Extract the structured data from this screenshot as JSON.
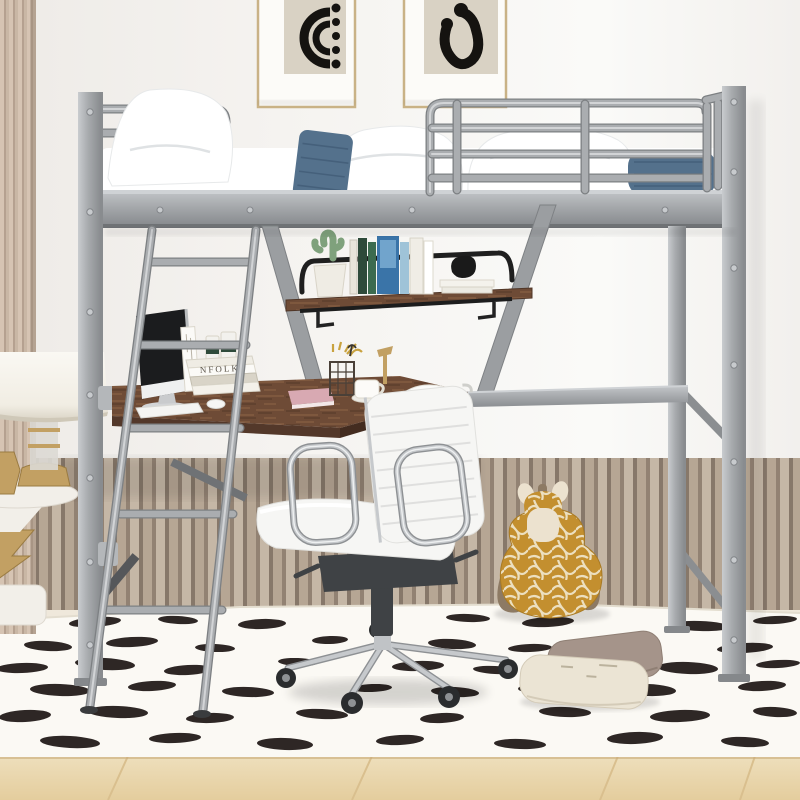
{
  "meta": {
    "type": "product-photo",
    "subject": "Silver metal twin loft bed with built-in L-shaped desk and shelf in a kids room with white office chair, giraffe plush, spotted rug and slat-panel wainscoting"
  },
  "palette": {
    "wall": "#f4f2ef",
    "wall_bright": "#fbfaf8",
    "wainscot_light": "#d0c1af",
    "wainscot_mid": "#c0af9c",
    "wainscot_dark": "#8f7f70",
    "wainscot_dark2": "#9a897a",
    "baseboard": "#efe8db",
    "floor_cream": "#f0ead9",
    "floor_wood": "#e9d5ab",
    "floor_wood_dark": "#d9bf8e",
    "rug": "#fbf9f4",
    "rug_spot": "#1c1512",
    "metal": "#a8abae",
    "metal_light": "#cdd0d3",
    "metal_dark": "#85888b",
    "wood_desk": "#6e4b36",
    "wood_desk_edge": "#53382a",
    "wood_streak": "#8a5f43",
    "shelf_rail": "#222222",
    "mattress": "#ffffff",
    "cushion_blue": "#54718c",
    "cushion_blue_dark": "#3f5a74",
    "chair_white": "#f6f6f4",
    "chrome": "#c6c9cc",
    "mech_dark": "#3f4245",
    "caster": "#2a2c2e",
    "giraffe": "#c38f2f",
    "giraffe_cream": "#ece2cf",
    "giraffe_brown": "#8d7a64",
    "pillow_taupe": "#a5948a",
    "pillow_cream": "#ebe4d4",
    "lamp_shade": "#f6f3ec",
    "gold": "#c2a063",
    "gold_dark": "#9a7b42",
    "marble": "#f2efe9",
    "curtain_light": "#d6c4b3",
    "curtain_mid": "#c9b7a5",
    "curtain_dark": "#b5a190",
    "art_bg": "#d9d2c4",
    "art_ink": "#151310",
    "frame_gold": "#c9b286",
    "mat_white": "#fcfbf8"
  },
  "text": {
    "desk_book_spine": "NFOLK"
  },
  "objects": [
    "framed abstract art print with concentric arcs",
    "framed abstract art print with ear-shaped hook",
    "beige striped curtain edge",
    "silver metal loft bed frame with guardrails",
    "white mattress with white pillows and two denim blue cushions",
    "slanted silver metal ladder",
    "hanging shelf with cactus, books and knot sculpture",
    "L-shaped walnut desk with monitor, book stack, candles, pink book, wire pencil cup, mug and gold lamp",
    "white ribbed office chair with chrome base and casters",
    "white drum-shade table lamp on marble and gold side table",
    "plush giraffe toy",
    "two floor pillows (taupe and cream)",
    "white rug with black brush-dash spots",
    "slat panel wainscoting",
    "light oak wood floor"
  ],
  "rug": {
    "spot_color": "#1c1512",
    "spots": [
      [
        95,
        622,
        26,
        5,
        -4
      ],
      [
        178,
        620,
        20,
        4,
        3
      ],
      [
        262,
        624,
        24,
        5,
        -2
      ],
      [
        468,
        618,
        22,
        4,
        2
      ],
      [
        548,
        622,
        26,
        5,
        -3
      ],
      [
        700,
        626,
        30,
        5,
        2
      ],
      [
        775,
        620,
        22,
        4,
        -3
      ],
      [
        48,
        646,
        24,
        5,
        3
      ],
      [
        132,
        642,
        26,
        5,
        -3
      ],
      [
        215,
        648,
        20,
        4,
        2
      ],
      [
        330,
        640,
        18,
        4,
        -2
      ],
      [
        452,
        644,
        24,
        5,
        3
      ],
      [
        530,
        648,
        22,
        4,
        -2
      ],
      [
        615,
        642,
        26,
        5,
        2
      ],
      [
        745,
        648,
        28,
        5,
        -3
      ],
      [
        22,
        668,
        26,
        5,
        -2
      ],
      [
        105,
        664,
        30,
        6,
        3
      ],
      [
        188,
        670,
        24,
        5,
        -3
      ],
      [
        298,
        662,
        20,
        4,
        2
      ],
      [
        418,
        666,
        26,
        5,
        -2
      ],
      [
        495,
        670,
        22,
        4,
        3
      ],
      [
        582,
        664,
        24,
        5,
        -2
      ],
      [
        688,
        668,
        30,
        6,
        2
      ],
      [
        778,
        664,
        22,
        4,
        -3
      ],
      [
        60,
        690,
        30,
        6,
        2
      ],
      [
        152,
        686,
        24,
        5,
        -3
      ],
      [
        248,
        692,
        26,
        5,
        2
      ],
      [
        372,
        688,
        20,
        4,
        -2
      ],
      [
        455,
        692,
        24,
        5,
        3
      ],
      [
        540,
        688,
        22,
        5,
        -2
      ],
      [
        648,
        690,
        28,
        6,
        2
      ],
      [
        762,
        686,
        24,
        5,
        -3
      ],
      [
        25,
        716,
        26,
        6,
        -3
      ],
      [
        118,
        712,
        30,
        6,
        2
      ],
      [
        210,
        718,
        24,
        5,
        -2
      ],
      [
        322,
        714,
        26,
        5,
        3
      ],
      [
        442,
        718,
        22,
        5,
        -3
      ],
      [
        565,
        712,
        26,
        5,
        2
      ],
      [
        680,
        716,
        30,
        6,
        -2
      ],
      [
        775,
        712,
        22,
        5,
        3
      ],
      [
        70,
        742,
        30,
        6,
        3
      ],
      [
        175,
        738,
        26,
        5,
        -2
      ],
      [
        285,
        744,
        28,
        6,
        2
      ],
      [
        400,
        740,
        24,
        5,
        -3
      ],
      [
        520,
        744,
        26,
        5,
        2
      ],
      [
        635,
        738,
        28,
        6,
        -2
      ],
      [
        745,
        742,
        24,
        5,
        3
      ]
    ]
  }
}
